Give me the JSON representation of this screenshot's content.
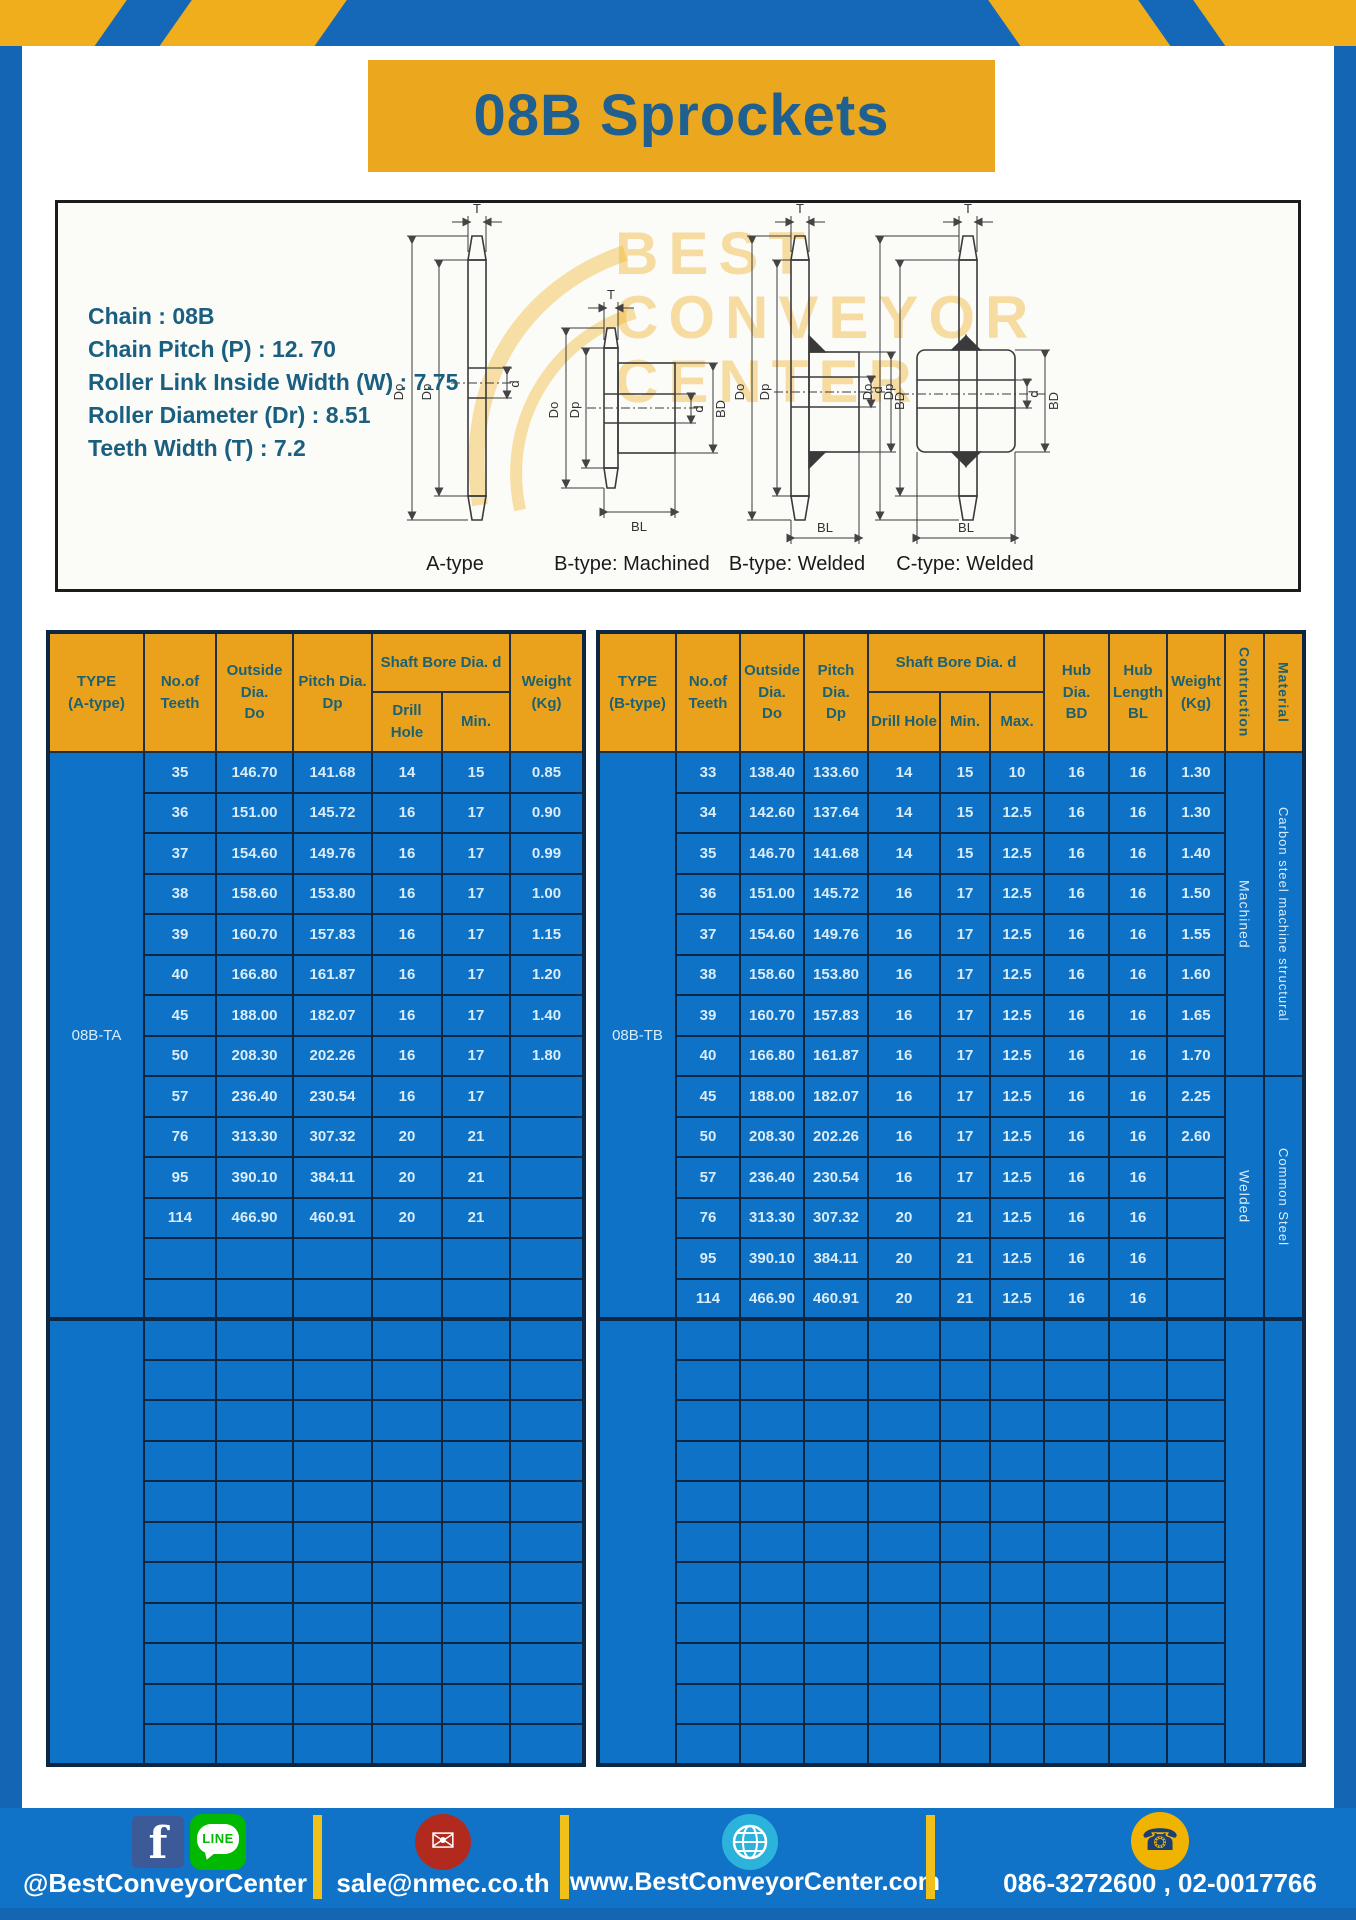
{
  "page": {
    "title": "08B Sprockets"
  },
  "specs": {
    "lines": [
      "Chain : 08B",
      "Chain Pitch (P) : 12. 70",
      "Roller Link Inside Width (W) : 7.75",
      "Roller Diameter (Dr) : 8.51",
      "Teeth Width (T) : 7.2"
    ]
  },
  "diagram": {
    "labels": [
      "A-type",
      "B-type: Machined",
      "B-type: Welded",
      "C-type: Welded"
    ],
    "dims": {
      "t": "T",
      "dout": "Do",
      "dp": "Dp",
      "d": "d",
      "bd": "BD",
      "bl": "BL"
    },
    "watermark": [
      "BEST",
      "CONVEYOR",
      "CENTER"
    ]
  },
  "table_a": {
    "headers": {
      "type": "TYPE\n(A-type)",
      "teeth": "No.of\nTeeth",
      "outside": "Outside\nDia.\nDo",
      "pitch": "Pitch Dia.\nDp",
      "shaft": "Shaft Bore Dia. d",
      "drill": "Drill Hole",
      "min": "Min.",
      "weight": "Weight\n(Kg)"
    },
    "type_label": "08B-TA",
    "rows": [
      [
        "35",
        "146.70",
        "141.68",
        "14",
        "15",
        "0.85"
      ],
      [
        "36",
        "151.00",
        "145.72",
        "16",
        "17",
        "0.90"
      ],
      [
        "37",
        "154.60",
        "149.76",
        "16",
        "17",
        "0.99"
      ],
      [
        "38",
        "158.60",
        "153.80",
        "16",
        "17",
        "1.00"
      ],
      [
        "39",
        "160.70",
        "157.83",
        "16",
        "17",
        "1.15"
      ],
      [
        "40",
        "166.80",
        "161.87",
        "16",
        "17",
        "1.20"
      ],
      [
        "45",
        "188.00",
        "182.07",
        "16",
        "17",
        "1.40"
      ],
      [
        "50",
        "208.30",
        "202.26",
        "16",
        "17",
        "1.80"
      ],
      [
        "57",
        "236.40",
        "230.54",
        "16",
        "17",
        ""
      ],
      [
        "76",
        "313.30",
        "307.32",
        "20",
        "21",
        ""
      ],
      [
        "95",
        "390.10",
        "384.11",
        "20",
        "21",
        ""
      ],
      [
        "114",
        "466.90",
        "460.91",
        "20",
        "21",
        ""
      ]
    ],
    "block1_rows": 14,
    "empty_rows": 11
  },
  "table_b": {
    "headers": {
      "type": "TYPE\n(B-type)",
      "teeth": "No.of\nTeeth",
      "outside": "Outside\nDia.\nDo",
      "pitch": "Pitch Dia.\nDp",
      "shaft": "Shaft Bore Dia. d",
      "drill": "Drill Hole",
      "min": "Min.",
      "max": "Max.",
      "hub_dia": "Hub Dia.\nBD",
      "hub_len": "Hub\nLength\nBL",
      "weight": "Weight\n(Kg)",
      "construction": "Contruction",
      "material": "Material"
    },
    "type_label": "08B-TB",
    "rows": [
      [
        "33",
        "138.40",
        "133.60",
        "14",
        "15",
        "10",
        "16",
        "16",
        "1.30"
      ],
      [
        "34",
        "142.60",
        "137.64",
        "14",
        "15",
        "12.5",
        "16",
        "16",
        "1.30"
      ],
      [
        "35",
        "146.70",
        "141.68",
        "14",
        "15",
        "12.5",
        "16",
        "16",
        "1.40"
      ],
      [
        "36",
        "151.00",
        "145.72",
        "16",
        "17",
        "12.5",
        "16",
        "16",
        "1.50"
      ],
      [
        "37",
        "154.60",
        "149.76",
        "16",
        "17",
        "12.5",
        "16",
        "16",
        "1.55"
      ],
      [
        "38",
        "158.60",
        "153.80",
        "16",
        "17",
        "12.5",
        "16",
        "16",
        "1.60"
      ],
      [
        "39",
        "160.70",
        "157.83",
        "16",
        "17",
        "12.5",
        "16",
        "16",
        "1.65"
      ],
      [
        "40",
        "166.80",
        "161.87",
        "16",
        "17",
        "12.5",
        "16",
        "16",
        "1.70"
      ],
      [
        "45",
        "188.00",
        "182.07",
        "16",
        "17",
        "12.5",
        "16",
        "16",
        "2.25"
      ],
      [
        "50",
        "208.30",
        "202.26",
        "16",
        "17",
        "12.5",
        "16",
        "16",
        "2.60"
      ],
      [
        "57",
        "236.40",
        "230.54",
        "16",
        "17",
        "12.5",
        "16",
        "16",
        ""
      ],
      [
        "76",
        "313.30",
        "307.32",
        "20",
        "21",
        "12.5",
        "16",
        "16",
        ""
      ],
      [
        "95",
        "390.10",
        "384.11",
        "20",
        "21",
        "12.5",
        "16",
        "16",
        ""
      ],
      [
        "114",
        "466.90",
        "460.91",
        "20",
        "21",
        "12.5",
        "16",
        "16",
        ""
      ]
    ],
    "block1_rows": 14,
    "construction_blocks": [
      {
        "label": "Machined",
        "span": 8
      },
      {
        "label": "Welded",
        "span": 6
      }
    ],
    "material_blocks": [
      {
        "label": "Carbon steel  machine structural",
        "span": 8
      },
      {
        "label": "Common  Steel",
        "span": 6
      }
    ],
    "empty_rows": 11
  },
  "footer": {
    "social_handle": "@BestConveyorCenter",
    "email": "sale@nmec.co.th",
    "website": "www.BestConveyorCenter.com",
    "phones": "086-3272600 , 02-0017766",
    "line_label": "LINE"
  },
  "icons": {
    "facebook": "f",
    "mail": "✉",
    "phone": "☎"
  },
  "colors": {
    "frame_blue": "#1465b4",
    "stripe_gold": "#f0ad1c",
    "header_gold": "#eaa21c",
    "table_blue": "#0e72c6",
    "footer_blue": "#1173c7",
    "title_text": "#1f6090"
  }
}
